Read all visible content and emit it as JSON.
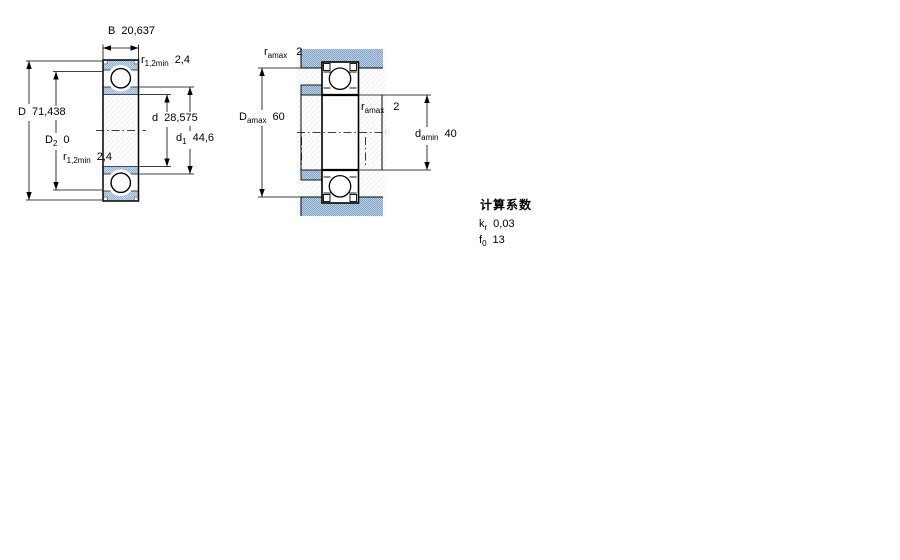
{
  "figure": {
    "left_view": {
      "B": {
        "symbol": "B",
        "value": "20,637"
      },
      "r12_top": {
        "symbol": "r",
        "sub": "1,2min",
        "value": "2,4"
      },
      "D": {
        "symbol": "D",
        "value": "71,438"
      },
      "D2": {
        "symbol": "D",
        "sub": "2",
        "value": "0"
      },
      "r12_bottom": {
        "symbol": "r",
        "sub": "1,2min",
        "value": "2,4"
      },
      "d": {
        "symbol": "d",
        "value": "28,575"
      },
      "d1": {
        "symbol": "d",
        "sub": "1",
        "value": "44,6"
      }
    },
    "right_view": {
      "ra_top": {
        "symbol": "r",
        "sub": "amax",
        "value": "2"
      },
      "Da_max": {
        "symbol": "D",
        "sub": "amax",
        "value": "60"
      },
      "ra_mid": {
        "symbol": "r",
        "sub": "amax",
        "value": "2"
      },
      "da_min": {
        "symbol": "d",
        "sub": "amin",
        "value": "40"
      }
    },
    "calculation_factors": {
      "title": "计算系数",
      "rows": [
        {
          "symbol": "k",
          "sub": "r",
          "value": "0,03"
        },
        {
          "symbol": "f",
          "sub": "0",
          "value": "13"
        }
      ]
    },
    "colors": {
      "section_fill_light": "#aac4dc",
      "section_fill_dot": "#8fb0d0",
      "housing_fill": "#b7cbdf",
      "housing_fill_dot": "#7aa2c6",
      "outline": "#000000",
      "background": "#ffffff"
    }
  }
}
